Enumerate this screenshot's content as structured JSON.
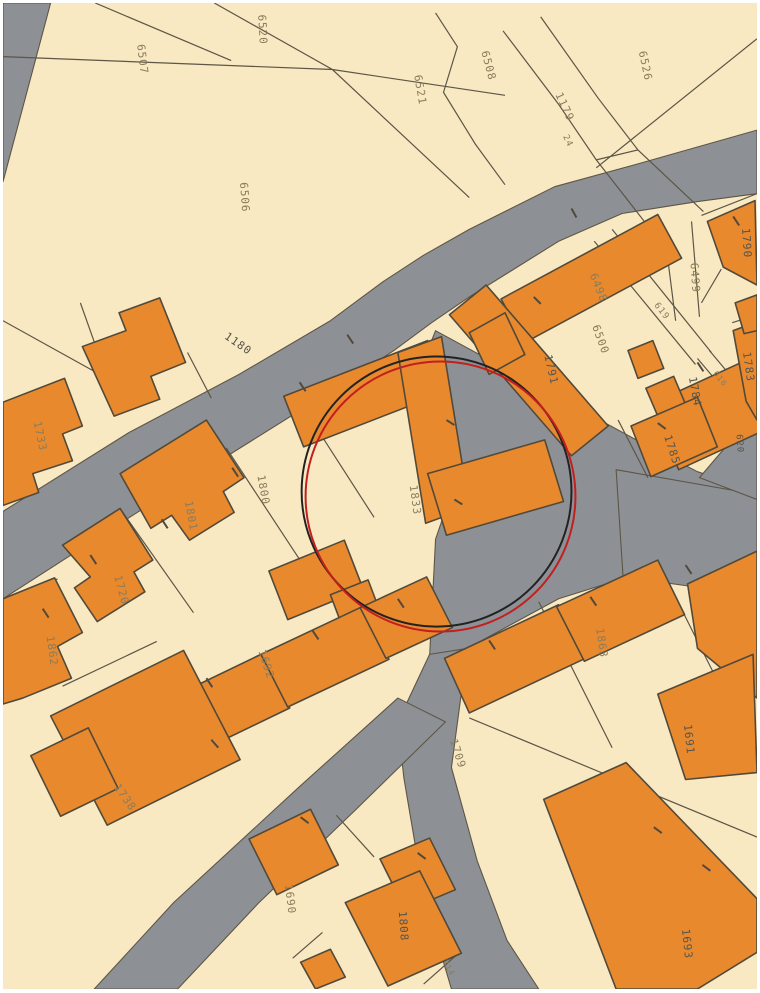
{
  "map": {
    "type": "cadastral-parcel-map",
    "colors": {
      "parcel": "#f8e9c2",
      "building": "#e8892e",
      "road": "#8d9196",
      "outline": "#51493a",
      "line": "#5d5546",
      "label": "#8a7c5b",
      "label_dark": "#55544d",
      "circle_red": "#c41e1e",
      "circle_black": "#222222"
    },
    "highlight": {
      "cx": 437,
      "cy": 492,
      "r": 136,
      "cx2": 441,
      "cy2": 497,
      "r2": 136
    },
    "labels": [
      {
        "text": "6507"
      },
      {
        "text": "6520"
      },
      {
        "text": "6508"
      },
      {
        "text": "6521"
      },
      {
        "text": "6526"
      },
      {
        "text": "1179"
      },
      {
        "text": "24"
      },
      {
        "text": "6506"
      },
      {
        "text": "1180"
      },
      {
        "text": "1733"
      },
      {
        "text": "1801"
      },
      {
        "text": "1800"
      },
      {
        "text": "1833"
      },
      {
        "text": "1720"
      },
      {
        "text": "1862"
      },
      {
        "text": "1692"
      },
      {
        "text": "1738"
      },
      {
        "text": "1690"
      },
      {
        "text": "1808"
      },
      {
        "text": "314"
      },
      {
        "text": "1693"
      },
      {
        "text": "1691"
      },
      {
        "text": "1709"
      },
      {
        "text": "1863"
      },
      {
        "text": "6498"
      },
      {
        "text": "6500"
      },
      {
        "text": "6499"
      },
      {
        "text": "1790"
      },
      {
        "text": "1791"
      },
      {
        "text": "619"
      },
      {
        "text": "616"
      },
      {
        "text": "1783"
      },
      {
        "text": "1784"
      },
      {
        "text": "1785"
      },
      {
        "text": "620"
      }
    ]
  }
}
